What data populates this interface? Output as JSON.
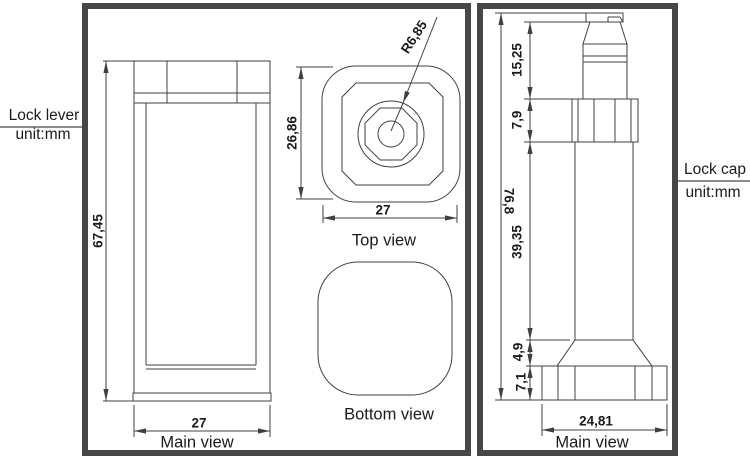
{
  "colors": {
    "line": "#404040",
    "panel_border": "#474747",
    "text": "#1b1b1b",
    "label_rule": "#8c8c8c",
    "background": "#ffffff"
  },
  "left_panel": {
    "label_title": "Lock lever",
    "label_unit": "unit:mm",
    "main_view": {
      "caption": "Main view",
      "dim_height": "67,45",
      "dim_width": "27"
    },
    "top_view": {
      "caption": "Top view",
      "dim_height": "26,86",
      "dim_width": "27",
      "dim_radius": "R6,85"
    },
    "bottom_view": {
      "caption": "Bottom view"
    }
  },
  "right_panel": {
    "label_title": "Lock cap",
    "label_unit": "unit:mm",
    "main_view": {
      "caption": "Main view",
      "dim_total_height": "76,8",
      "dim_cap_height": "15,25",
      "dim_collar_height": "7,9",
      "dim_shaft_height": "39,35",
      "dim_flare_height": "4,9",
      "dim_base_height": "7,1",
      "dim_base_width": "24,81"
    }
  }
}
